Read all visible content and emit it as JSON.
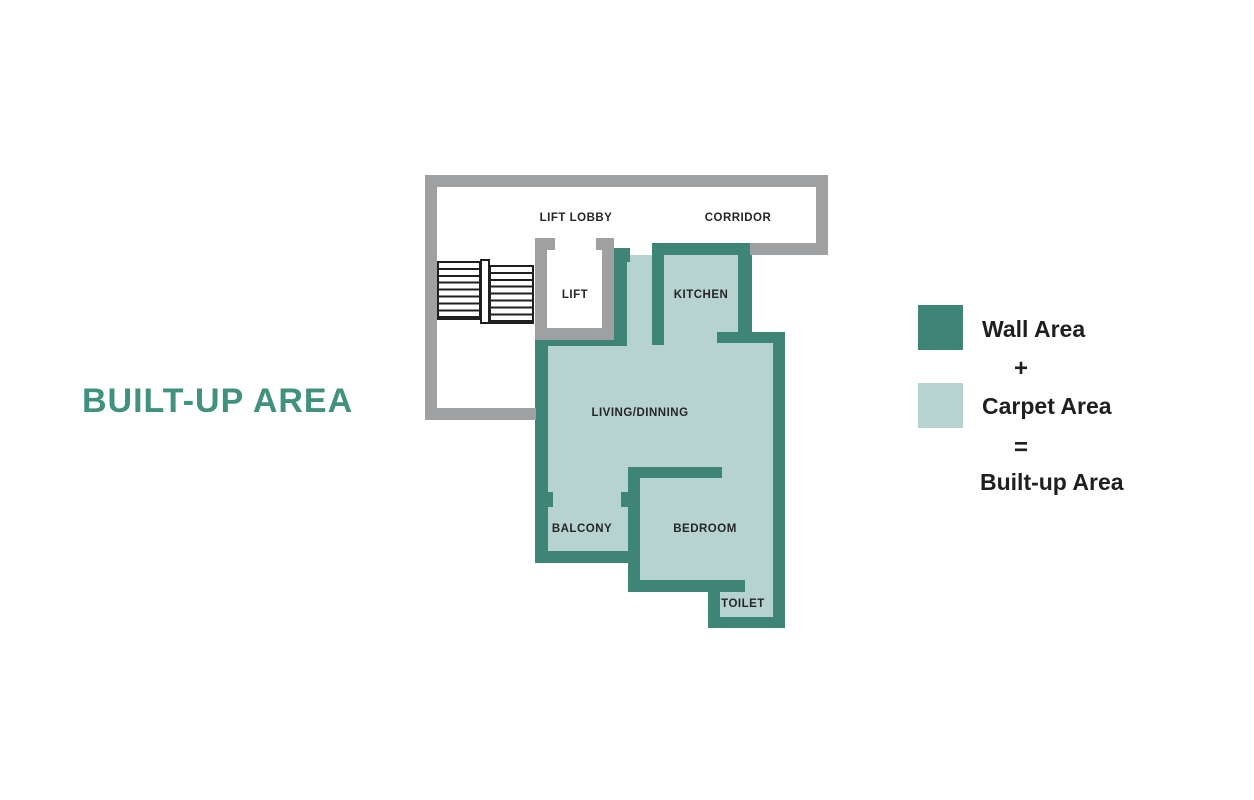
{
  "title": "BUILT-UP AREA",
  "colors": {
    "wall": "#3E8577",
    "carpet": "#B6D3D0",
    "gray": "#9EA0A1",
    "title": "#40917E",
    "label": "#262626"
  },
  "floorplan": {
    "labels": {
      "lift_lobby": "LIFT LOBBY",
      "corridor": "CORRIDOR",
      "lift": "LIFT",
      "kitchen": "KITCHEN",
      "living_dining": "LIVING/DINNING",
      "balcony": "BALCONY",
      "bedroom": "BEDROOM",
      "toilet": "TOILET"
    }
  },
  "legend": {
    "wall_label": "Wall Area",
    "plus_sign": "+",
    "carpet_label": "Carpet Area",
    "equals_sign": "=",
    "result_label": "Built-up Area"
  }
}
